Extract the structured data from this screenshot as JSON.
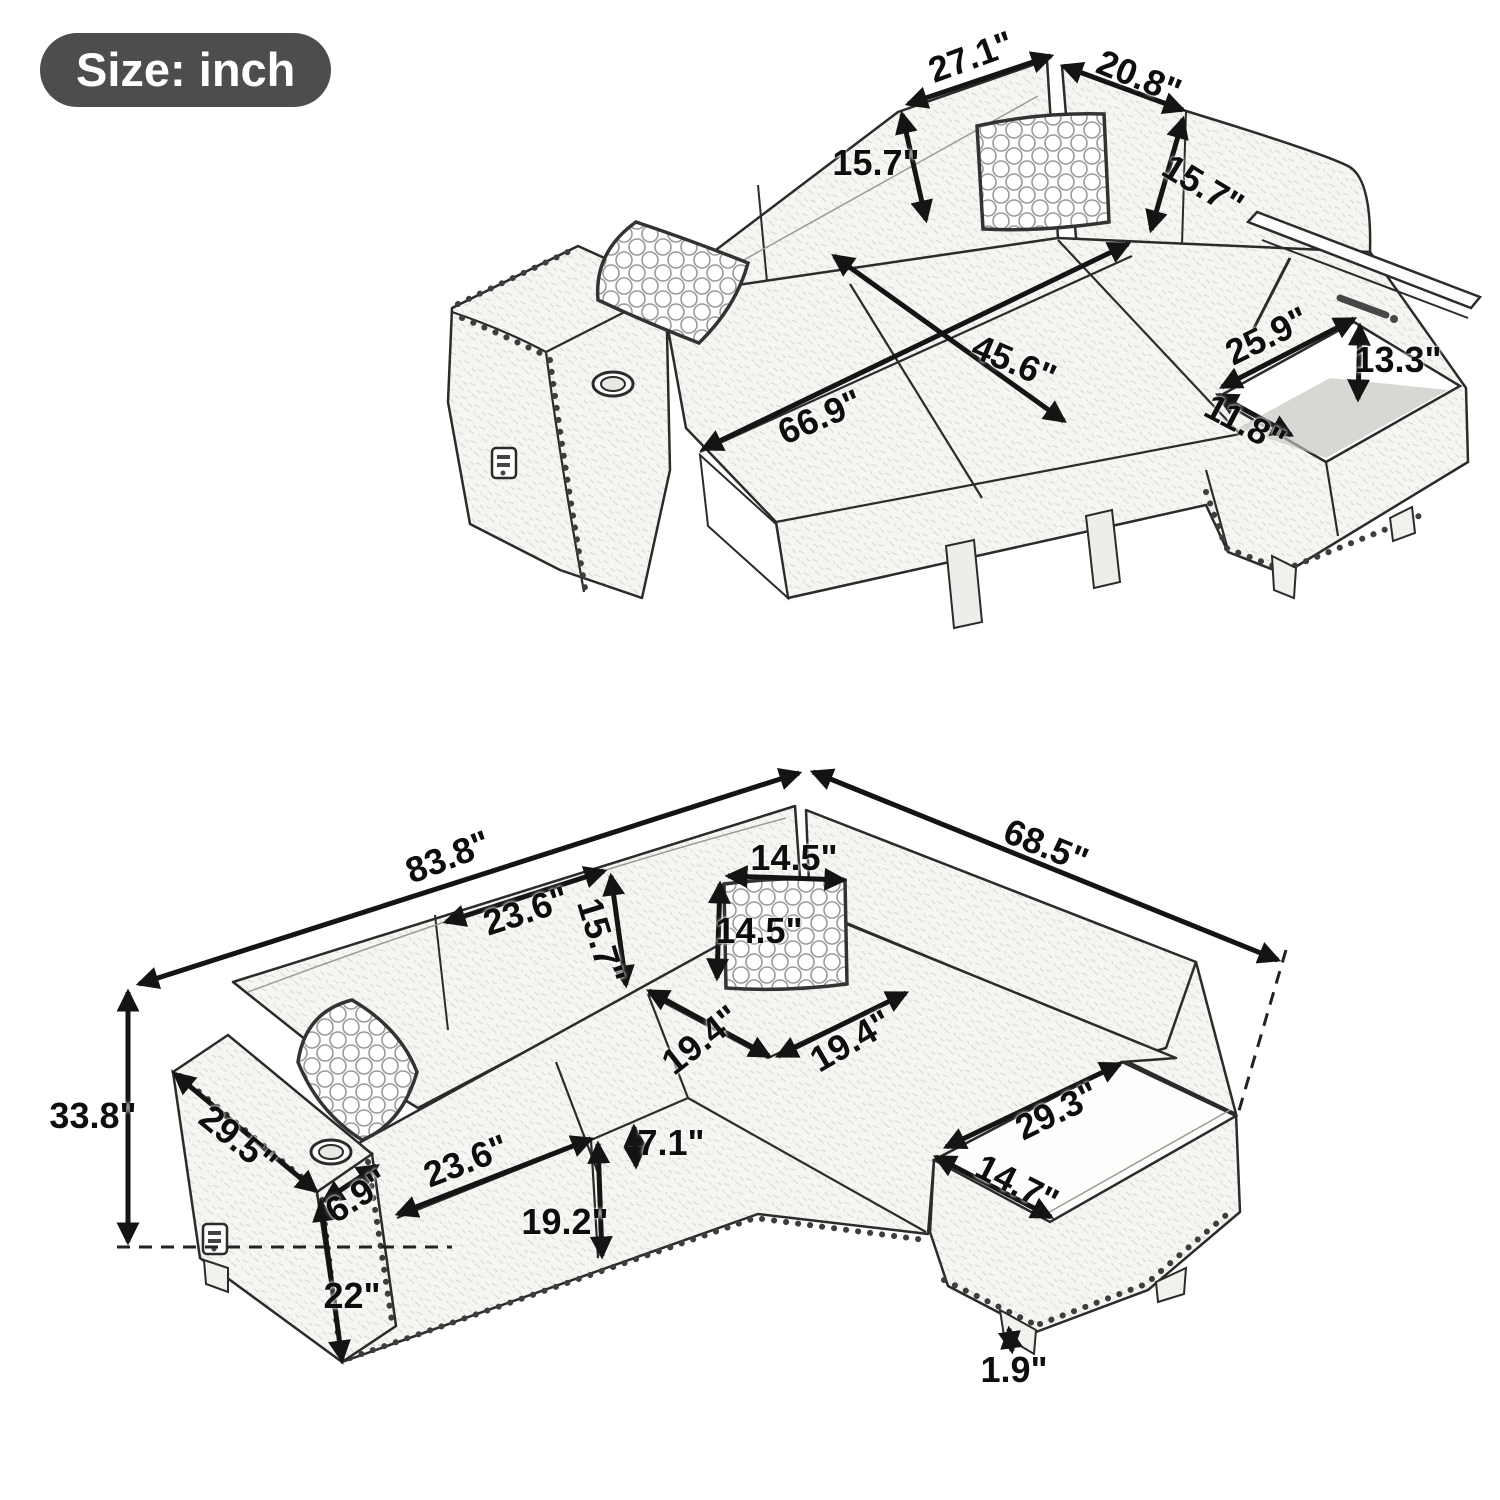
{
  "badge": {
    "label": "Size: inch"
  },
  "top_view": {
    "back_left_width": "27.1\"",
    "back_right_width": "20.8\"",
    "back_height_left": "15.7\"",
    "back_height_right": "15.7\"",
    "bed_width": "45.6\"",
    "bed_length": "66.9\"",
    "storage_opening_length": "25.9\"",
    "storage_depth": "13.3\"",
    "storage_opening_width": "11.8\""
  },
  "bottom_view": {
    "overall_length": "83.8\"",
    "overall_depth": "68.5\"",
    "pillow_width": "14.5\"",
    "pillow_height": "14.5\"",
    "back_cushion_width": "23.6\"",
    "back_cushion_height": "15.7\"",
    "seat_depth_left": "19.4\"",
    "seat_depth_right": "19.4\"",
    "overall_height": "33.8\"",
    "arm_length": "29.5\"",
    "arm_width": "6.9\"",
    "arm_front_height": "22\"",
    "seat_cushion_width": "23.6\"",
    "seat_front_height": "19.2\"",
    "seat_cushion_thickness": "7.1\"",
    "chaise_top_length": "29.3\"",
    "chaise_top_width": "14.7\"",
    "leg_height": "1.9\""
  }
}
